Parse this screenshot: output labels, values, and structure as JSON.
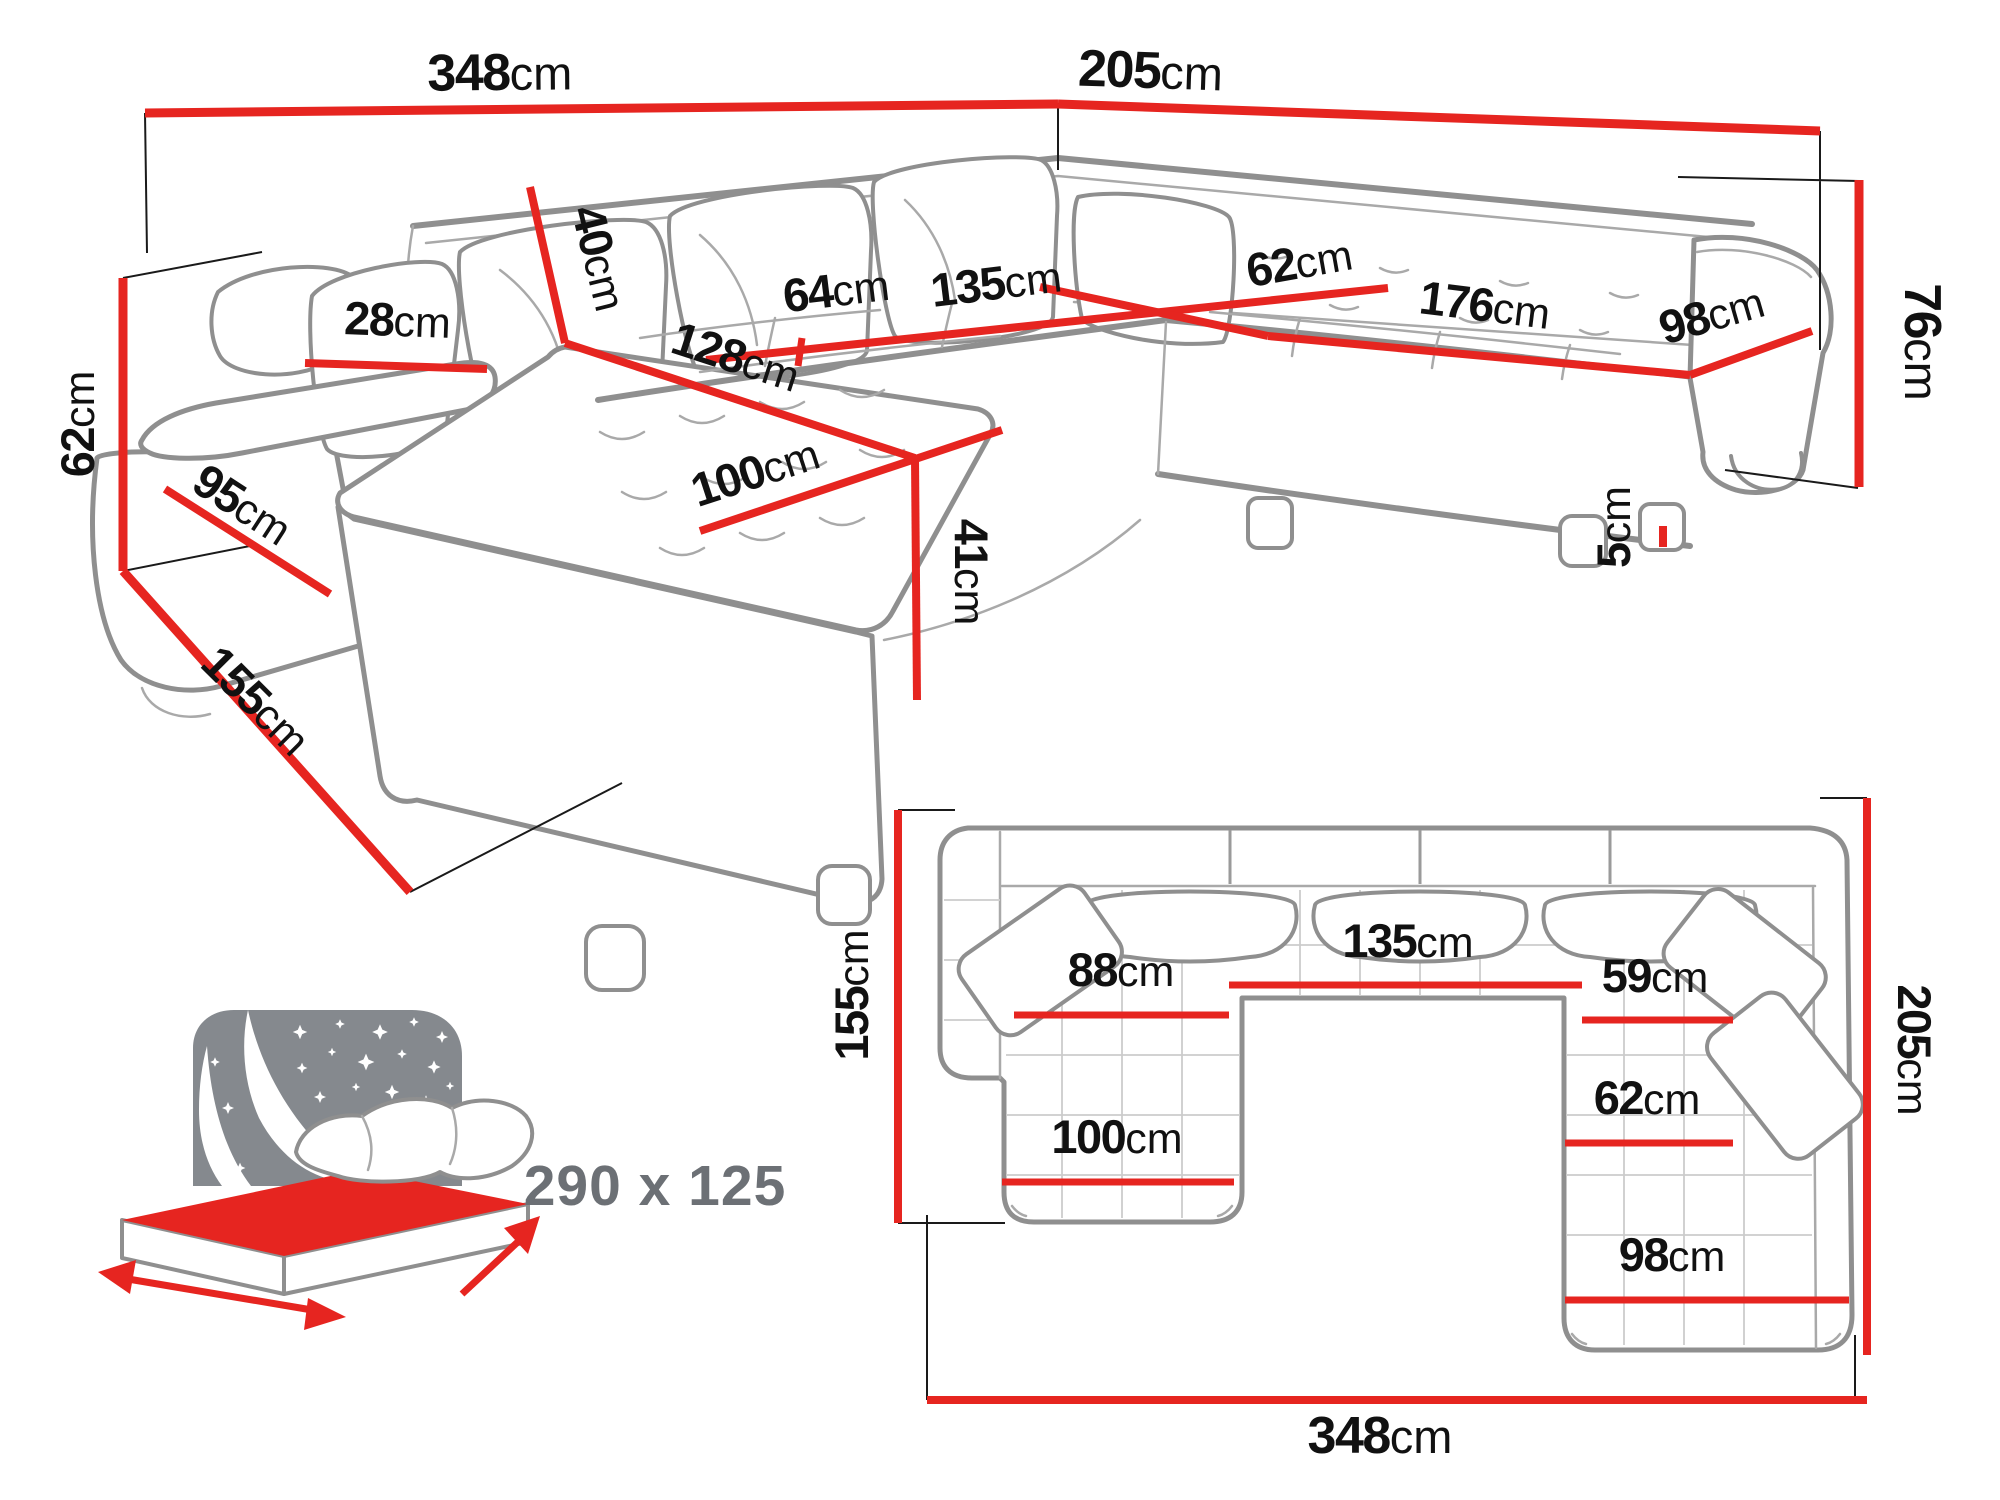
{
  "colors": {
    "dimension_red": "#e62520",
    "sofa_gray": "#8f8f8f",
    "label_black": "#111111",
    "bed_gray": "#85898e",
    "bed_label_gray": "#6c7075"
  },
  "perspective_view": {
    "labels": {
      "total_width": {
        "value": "348",
        "unit": "cm"
      },
      "total_depth_right": {
        "value": "205",
        "unit": "cm"
      },
      "back_cushion_height": {
        "value": "40",
        "unit": "cm"
      },
      "side_height": {
        "value": "62",
        "unit": "cm"
      },
      "armrest_width": {
        "value": "28",
        "unit": "cm"
      },
      "seat_depth": {
        "value": "64",
        "unit": "cm"
      },
      "middle_seat_width": {
        "value": "135",
        "unit": "cm"
      },
      "corner_seat_depth": {
        "value": "62",
        "unit": "cm"
      },
      "right_seat_width": {
        "value": "176",
        "unit": "cm"
      },
      "end_seat_width": {
        "value": "98",
        "unit": "cm"
      },
      "backrest_height": {
        "value": "76",
        "unit": "cm"
      },
      "chaise_length": {
        "value": "128",
        "unit": "cm"
      },
      "side_depth": {
        "value": "95",
        "unit": "cm"
      },
      "chaise_width": {
        "value": "100",
        "unit": "cm"
      },
      "seat_height": {
        "value": "41",
        "unit": "cm"
      },
      "leg_height": {
        "value": "5",
        "unit": "cm"
      },
      "total_depth_left": {
        "value": "155",
        "unit": "cm"
      }
    }
  },
  "plan_view": {
    "labels": {
      "depth_left": {
        "value": "155",
        "unit": "cm"
      },
      "chaise_inner": {
        "value": "88",
        "unit": "cm"
      },
      "middle_width": {
        "value": "135",
        "unit": "cm"
      },
      "right_inner": {
        "value": "59",
        "unit": "cm"
      },
      "depth_right": {
        "value": "205",
        "unit": "cm"
      },
      "corner_inner": {
        "value": "62",
        "unit": "cm"
      },
      "chaise_width": {
        "value": "100",
        "unit": "cm"
      },
      "end_width": {
        "value": "98",
        "unit": "cm"
      },
      "total_width": {
        "value": "348",
        "unit": "cm"
      }
    }
  },
  "bed_icon": {
    "name": "sofa-bed-sleeping-function-icon",
    "sleeping_area": "290 x 125"
  }
}
